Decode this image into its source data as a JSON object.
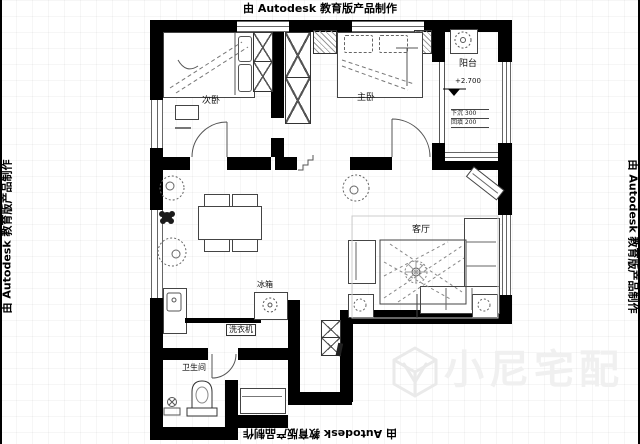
{
  "watermarks": {
    "top": "由 Autodesk 教育版产品制作",
    "bottom": "由 Autodesk 教育版产品制作",
    "left": "由 Autodesk 教育版产品制作",
    "right": "由 Autodesk 教育版产品制作"
  },
  "brand": {
    "name": "小尼宅配",
    "logo": "cube-n-logo",
    "color": "#f0f0f0"
  },
  "rooms": {
    "secondary_bedroom": "次卧",
    "master_bedroom": "主卧",
    "balcony": "阳台",
    "living_room": "客厅",
    "bathroom": "卫生间"
  },
  "annotations": {
    "balcony_elevation": "+2.700",
    "balcony_note_line1": "下沉 300",
    "balcony_note_line2": "回填 200",
    "fridge": "冰箱",
    "washing_machine_label": "洗衣机"
  },
  "colors": {
    "wall": "#000000",
    "linework": "#555555",
    "watermark_gray": "#f0f0f0"
  }
}
